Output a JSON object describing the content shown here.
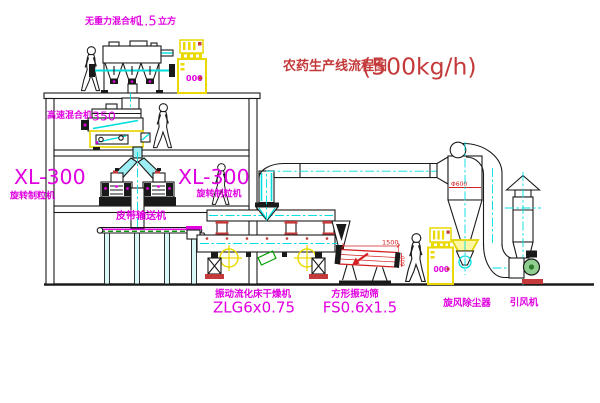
{
  "title": {
    "text": "农药生产线流程图",
    "capacity": "(500kg/h)"
  },
  "labels": {
    "gravity_mixer_name": "无重力混合机",
    "gravity_mixer_size": "1.5",
    "gravity_mixer_unit": "立方",
    "high_speed_mixer_name": "高速混合机",
    "high_speed_mixer_size": "350",
    "granulator_left_model": "XL-300",
    "granulator_left_name": "旋转制粒机",
    "granulator_right_model": "XL-300",
    "granulator_right_name": "旋转制粒机",
    "belt_conveyor": "皮带输送机",
    "dryer_name": "振动流化床干燥机",
    "dryer_model": "ZLG6x0.75",
    "screen_name": "方形振动筛",
    "screen_model": "FS0.6x1.5",
    "cyclone_name": "旋风除尘器",
    "fan_name": "引风机"
  },
  "dimensions": {
    "screen_length": "1500",
    "screen_width": "600",
    "cyclone_inlet": "Φ600"
  },
  "cabinets": {
    "display": "000"
  },
  "colors": {
    "label_magenta": "#e000e0",
    "title_red": "#c43a3a",
    "centerline_cyan": "#00dede",
    "highlight_yellow": "#ead900",
    "dimension_red": "#d42222",
    "conveyor_green": "#00a000",
    "pipe_fill_cyan": "#9deef2"
  }
}
